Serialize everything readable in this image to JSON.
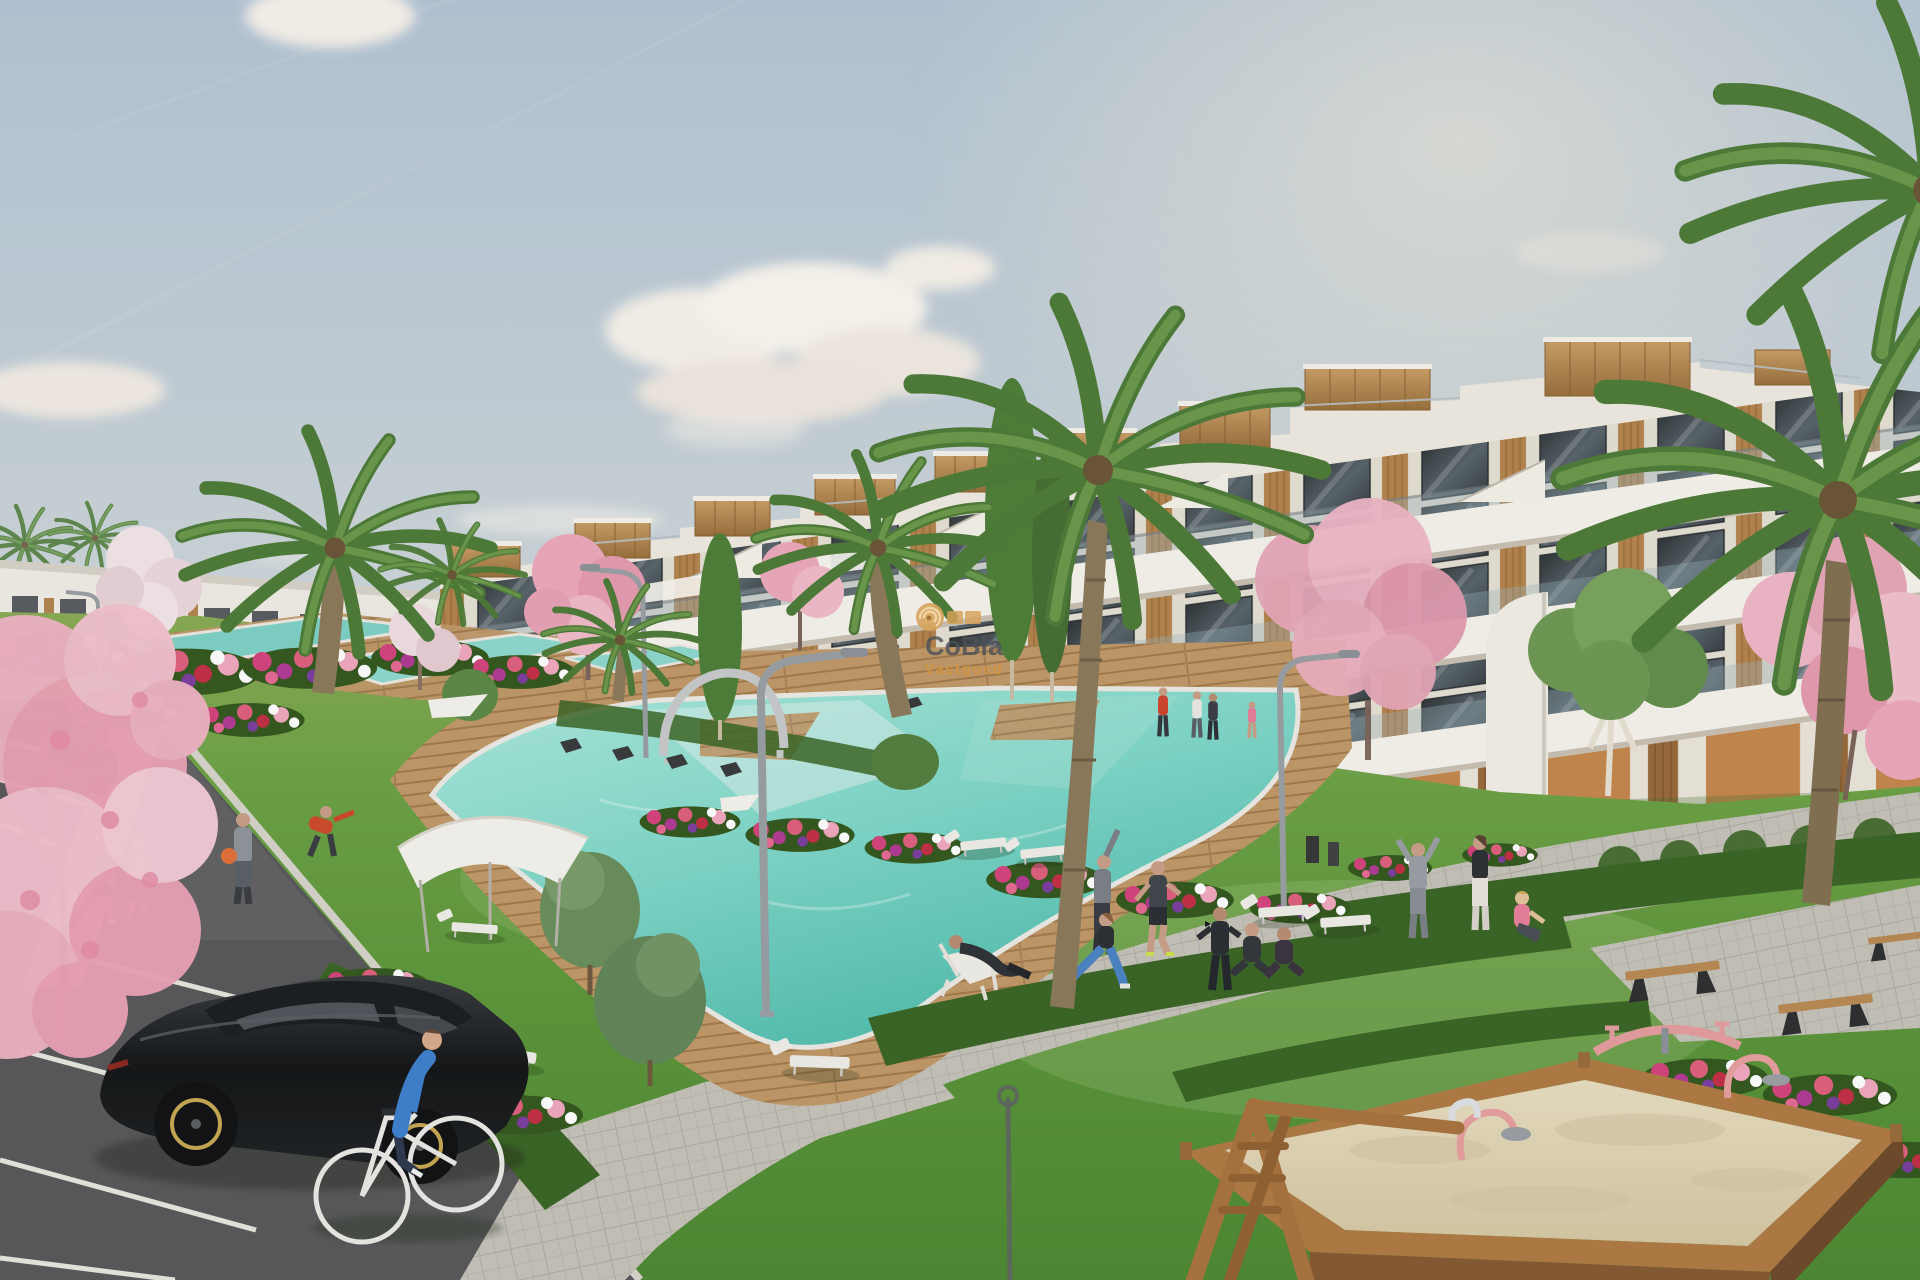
{
  "meta": {
    "domain": "Natural-Image",
    "title": "New-build residential complex exterior render",
    "description": "3D architectural visualization of a modern white terraced apartment complex with wood-clad roof volumes, communal lawns, turquoise pools with wooden decks, palm and cherry-blossom trees, a parking lane with cars, a cyclist, people exercising and a sand playground."
  },
  "watermark": {
    "brand": "CoBla",
    "subtitle": "Vastgoed",
    "logo": "concentric-rings-logo",
    "brand_color": "#4c5157",
    "subtitle_color": "#d09242",
    "logo_color": "#d6a058"
  },
  "palette": {
    "sky_top": "#b4c6d6",
    "sky_horizon": "#ece5d6",
    "cloud": "#f8f3ec",
    "building_white": "#f6f3ec",
    "facade_shadow": "#ded8cc",
    "glass": "#454c52",
    "wood": "#b5854f",
    "terracotta": "#c5884d",
    "grass": "#5f9c3e",
    "grass_far": "#86aa52",
    "hedge": "#3b6626",
    "pool": "#58c3b4",
    "pool_light": "#b4ece2",
    "deck": "#c2996a",
    "asphalt": "#59595b",
    "pavement": "#c6c3ba",
    "sand": "#e2d7ba",
    "blossom": "#eeaabc",
    "palm": "#567f3b"
  },
  "scene": {
    "elements": [
      "sky",
      "clouds",
      "distant-buildings",
      "apartment-building",
      "roof-wood-boxes",
      "stair-parapets",
      "balcony-glass",
      "palm-trees",
      "cherry-blossom-trees",
      "cypress-trees",
      "olive-bushes",
      "flower-beds",
      "hedges",
      "lawns",
      "swimming-pools",
      "wood-deck",
      "shade-canopy",
      "pergola-arch",
      "street-lamps",
      "sun-loungers",
      "benches",
      "walking-people",
      "exercising-people",
      "cyclist",
      "black-car",
      "parked-cars",
      "road-parking",
      "sidewalks",
      "sandbox",
      "swing-frame",
      "spring-riders",
      "seesaw",
      "watermark"
    ]
  }
}
